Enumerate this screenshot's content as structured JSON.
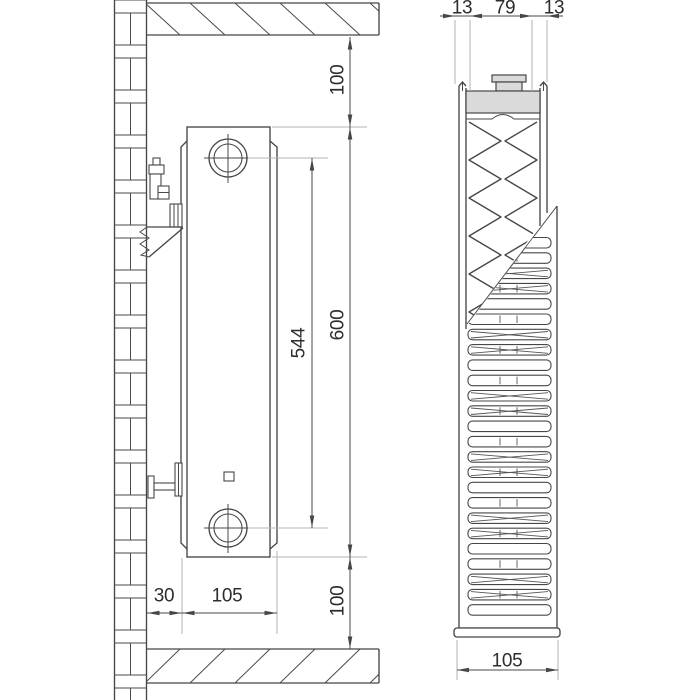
{
  "left_view": {
    "dimensions": {
      "top_clearance": "100",
      "radiator_height": "600",
      "connection_spacing": "544",
      "bottom_clearance": "100",
      "wall_distance": "30",
      "radiator_depth": "105"
    }
  },
  "right_view": {
    "dimensions": {
      "front_panel_thickness": "13",
      "core_width": "79",
      "back_panel_thickness": "13",
      "overall_depth": "105"
    }
  },
  "colors": {
    "line": "#464646",
    "extension_line": "#b6b6b6",
    "section_shading": "#dadada",
    "background": "#ffffff"
  }
}
